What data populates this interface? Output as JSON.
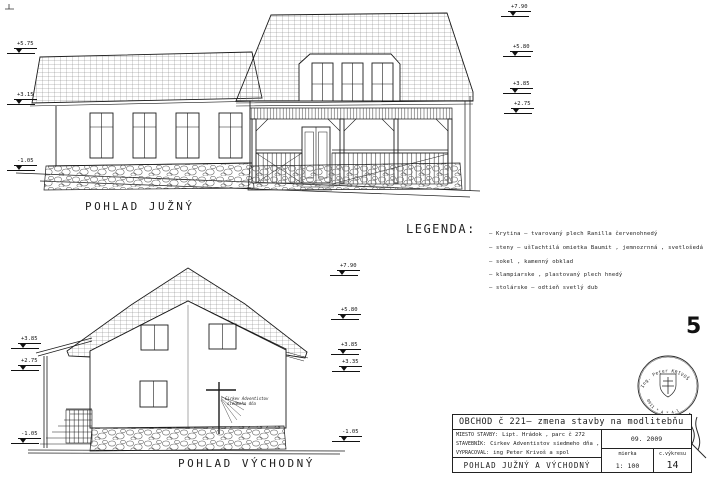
{
  "page": {
    "number": "5"
  },
  "south": {
    "label": "POHLAD JUŽNÝ",
    "levels_right": [
      "+7.90",
      "+5.80",
      "+3.85",
      "+2.75"
    ],
    "levels_left": [
      "+5.75",
      "+3.15",
      "-1.05"
    ]
  },
  "east": {
    "label": "POHLAD VÝCHODNÝ",
    "levels_right": [
      "+7.90",
      "+5.80",
      "+3.85",
      "+3.35",
      "-1.05"
    ],
    "levels_left": [
      "+3.85",
      "+2.75",
      "-1.05"
    ],
    "cross_text_1": "Cirkev Adventistov",
    "cross_text_2": "siedmeho dňa"
  },
  "legend": {
    "title": "LEGENDA:",
    "items": [
      "–  Krytina – tvarovaný plech Ranilla  červenohnedý",
      "–  steny – ušľachtilá omietka Baumit , jemnozrnná , svetlošedá",
      "–  sokel ,  kamenný obklad",
      "–  klampiarske , plastovaný plech hnedý",
      "–  stolárske – odtieň svetlý dub"
    ]
  },
  "titleblock": {
    "title": "OBCHOD č 221–  zmena  stavby   na  modlitebňu",
    "miesto_label": "MIESTO STAVBY:",
    "miesto_value": "Lipt. Hrádok  , parc č  272",
    "stavebnik_label": "STAVEBNÍK:",
    "stavebnik_value": "Cirkev Adventistov siedmeho dňa , Bratislava",
    "vypracoval_label": "VYPRACOVAL:",
    "vypracoval_value": "ing Peter Krivoš a spol",
    "drawing_name": "POHLAD  JUŽNÝ  A  VÝCHODNÝ",
    "date": "09. 2009",
    "scale_label": "mierka",
    "scale_value": "1: 100",
    "sheet_label": "c.výkresu",
    "sheet_value": "14"
  },
  "stamp": {
    "arc_top": "Ing. Peter KRIVOŠ",
    "arc_bottom": "0911 * A * 4-1"
  }
}
